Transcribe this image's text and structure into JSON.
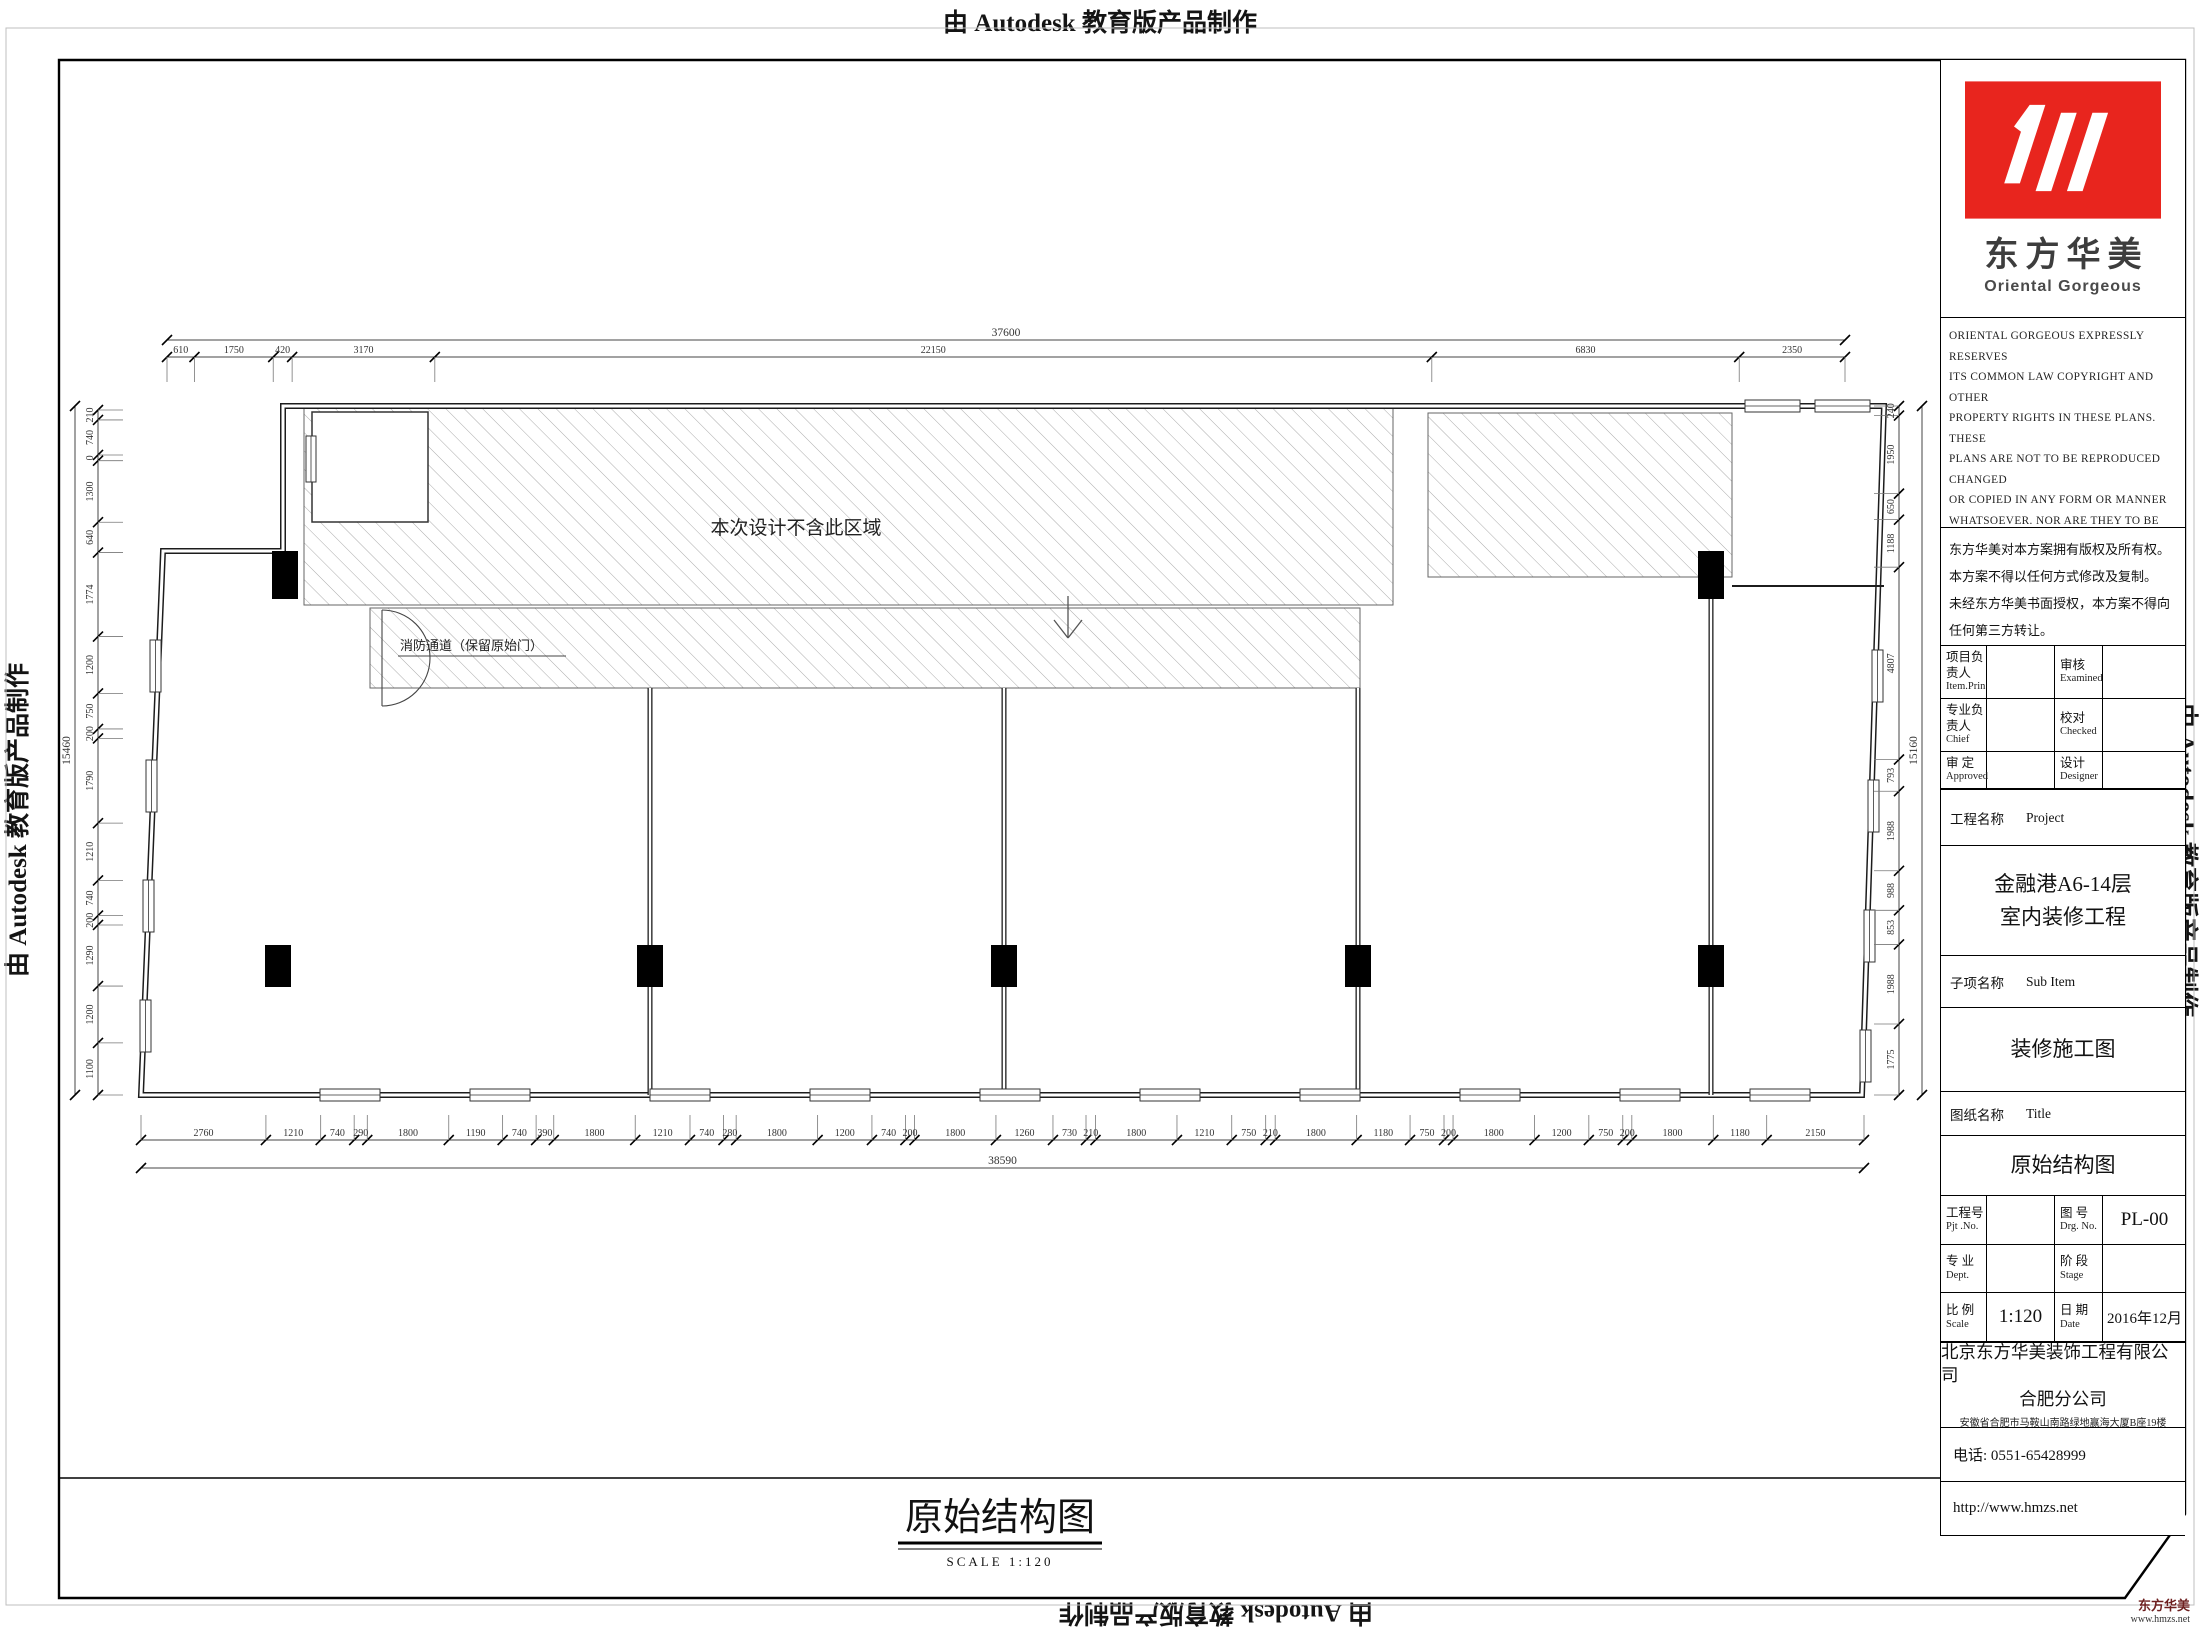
{
  "page": {
    "autodesk_banner": "由 Autodesk 教育版产品制作"
  },
  "footer": {
    "brand": "东方华美",
    "url": "www.hmzs.net"
  },
  "plan": {
    "excluded_area_label": "本次设计不含此区域",
    "fire_exit_label": "消防通道（保留原始门）",
    "drawing_title": "原始结构图",
    "drawing_scale": "SCALE  1:120",
    "dimensions": {
      "top_total": "37600",
      "top_segments": [
        "610",
        "1750",
        "420",
        "3170",
        "22150",
        "6830",
        "2350"
      ],
      "bottom_total": "38590",
      "bottom_segments": [
        "2760",
        "1210",
        "740",
        "290",
        "1800",
        "1190",
        "740",
        "390",
        "1800",
        "1210",
        "740",
        "280",
        "1800",
        "1200",
        "740",
        "200",
        "1800",
        "1260",
        "730",
        "210",
        "1800",
        "1210",
        "750",
        "210",
        "1800",
        "1180",
        "750",
        "200",
        "1800",
        "1200",
        "750",
        "200",
        "1800",
        "1180",
        "2150"
      ],
      "left_total": "15460",
      "left_segments": [
        "210",
        "740",
        "0",
        "1300",
        "640",
        "1774",
        "1200",
        "750",
        "200",
        "1790",
        "1210",
        "740",
        "200",
        "1290",
        "1200",
        "1100"
      ],
      "right_total": "15160",
      "right_segments": [
        "240",
        "1950",
        "650",
        "1188",
        "4807",
        "793",
        "1988",
        "988",
        "853",
        "1988",
        "1775"
      ]
    }
  },
  "title_block": {
    "logo": {
      "cn": "东方华美",
      "en": "Oriental  Gorgeous",
      "red": "#e8251e"
    },
    "copyright_en_lines": [
      "ORIENTAL GORGEOUS EXPRESSLY RESERVES",
      "ITS COMMON LAW COPYRIGHT AND OTHER",
      "PROPERTY RIGHTS IN THESE PLANS. THESE",
      "PLANS ARE NOT TO BE REPRODUCED CHANGED",
      "OR COPIED IN ANY FORM OR MANNER",
      "WHATSOEVER. NOR ARE THEY TO BE ASSIGHED",
      "TO ANY THIRD PARTY WITHOUT FIRST",
      "OBTAINING THE EXPRESSED WRITTEN",
      "PERMISSION AND CONSENT OF ORIENTAL",
      "GORGEOUS"
    ],
    "copyright_cn_lines": [
      "东方华美对本方案拥有版权及所有权。",
      "本方案不得以任何方式修改及复制。",
      "未经东方华美书面授权，本方案不得向",
      "任何第三方转让。"
    ],
    "personnel_rows": [
      {
        "label_cn": "项目负责人",
        "label_en": "Item.Prin",
        "value": "",
        "label2_cn": "审核",
        "label2_en": "Examined",
        "value2": ""
      },
      {
        "label_cn": "专业负责人",
        "label_en": "Chief",
        "value": "",
        "label2_cn": "校对",
        "label2_en": "Checked",
        "value2": ""
      },
      {
        "label_cn": "审 定",
        "label_en": "Approved",
        "value": "",
        "label2_cn": "设计",
        "label2_en": "Designer",
        "value2": ""
      }
    ],
    "project_row": {
      "cn": "工程名称",
      "en": "Project"
    },
    "project_name_lines": [
      "金融港A6-14层",
      "室内装修工程"
    ],
    "subitem_row": {
      "cn": "子项名称",
      "en": "Sub Item"
    },
    "subitem_value": "装修施工图",
    "sheet_row": {
      "cn": "图纸名称",
      "en": "Title"
    },
    "sheet_value": "原始结构图",
    "meta_rows": [
      {
        "label_cn": "工程号",
        "label_en": "Pjt .No.",
        "value": "",
        "label2_cn": "图 号",
        "label2_en": "Drg. No.",
        "value2": "PL-00"
      },
      {
        "label_cn": "专 业",
        "label_en": "Dept.",
        "value": "",
        "label2_cn": "阶 段",
        "label2_en": "Stage",
        "value2": ""
      },
      {
        "label_cn": "比 例",
        "label_en": "Scale",
        "value": "1:120",
        "label2_cn": "日 期",
        "label2_en": "Date",
        "value2": "2016年12月"
      }
    ],
    "company_name": "北京东方华美装饰工程有限公司",
    "company_branch": "合肥分公司",
    "company_address": "安徽省合肥市马鞍山南路绿地赢海大厦B座19楼",
    "phone": "电话: 0551-65428999",
    "website": "http://www.hmzs.net"
  }
}
